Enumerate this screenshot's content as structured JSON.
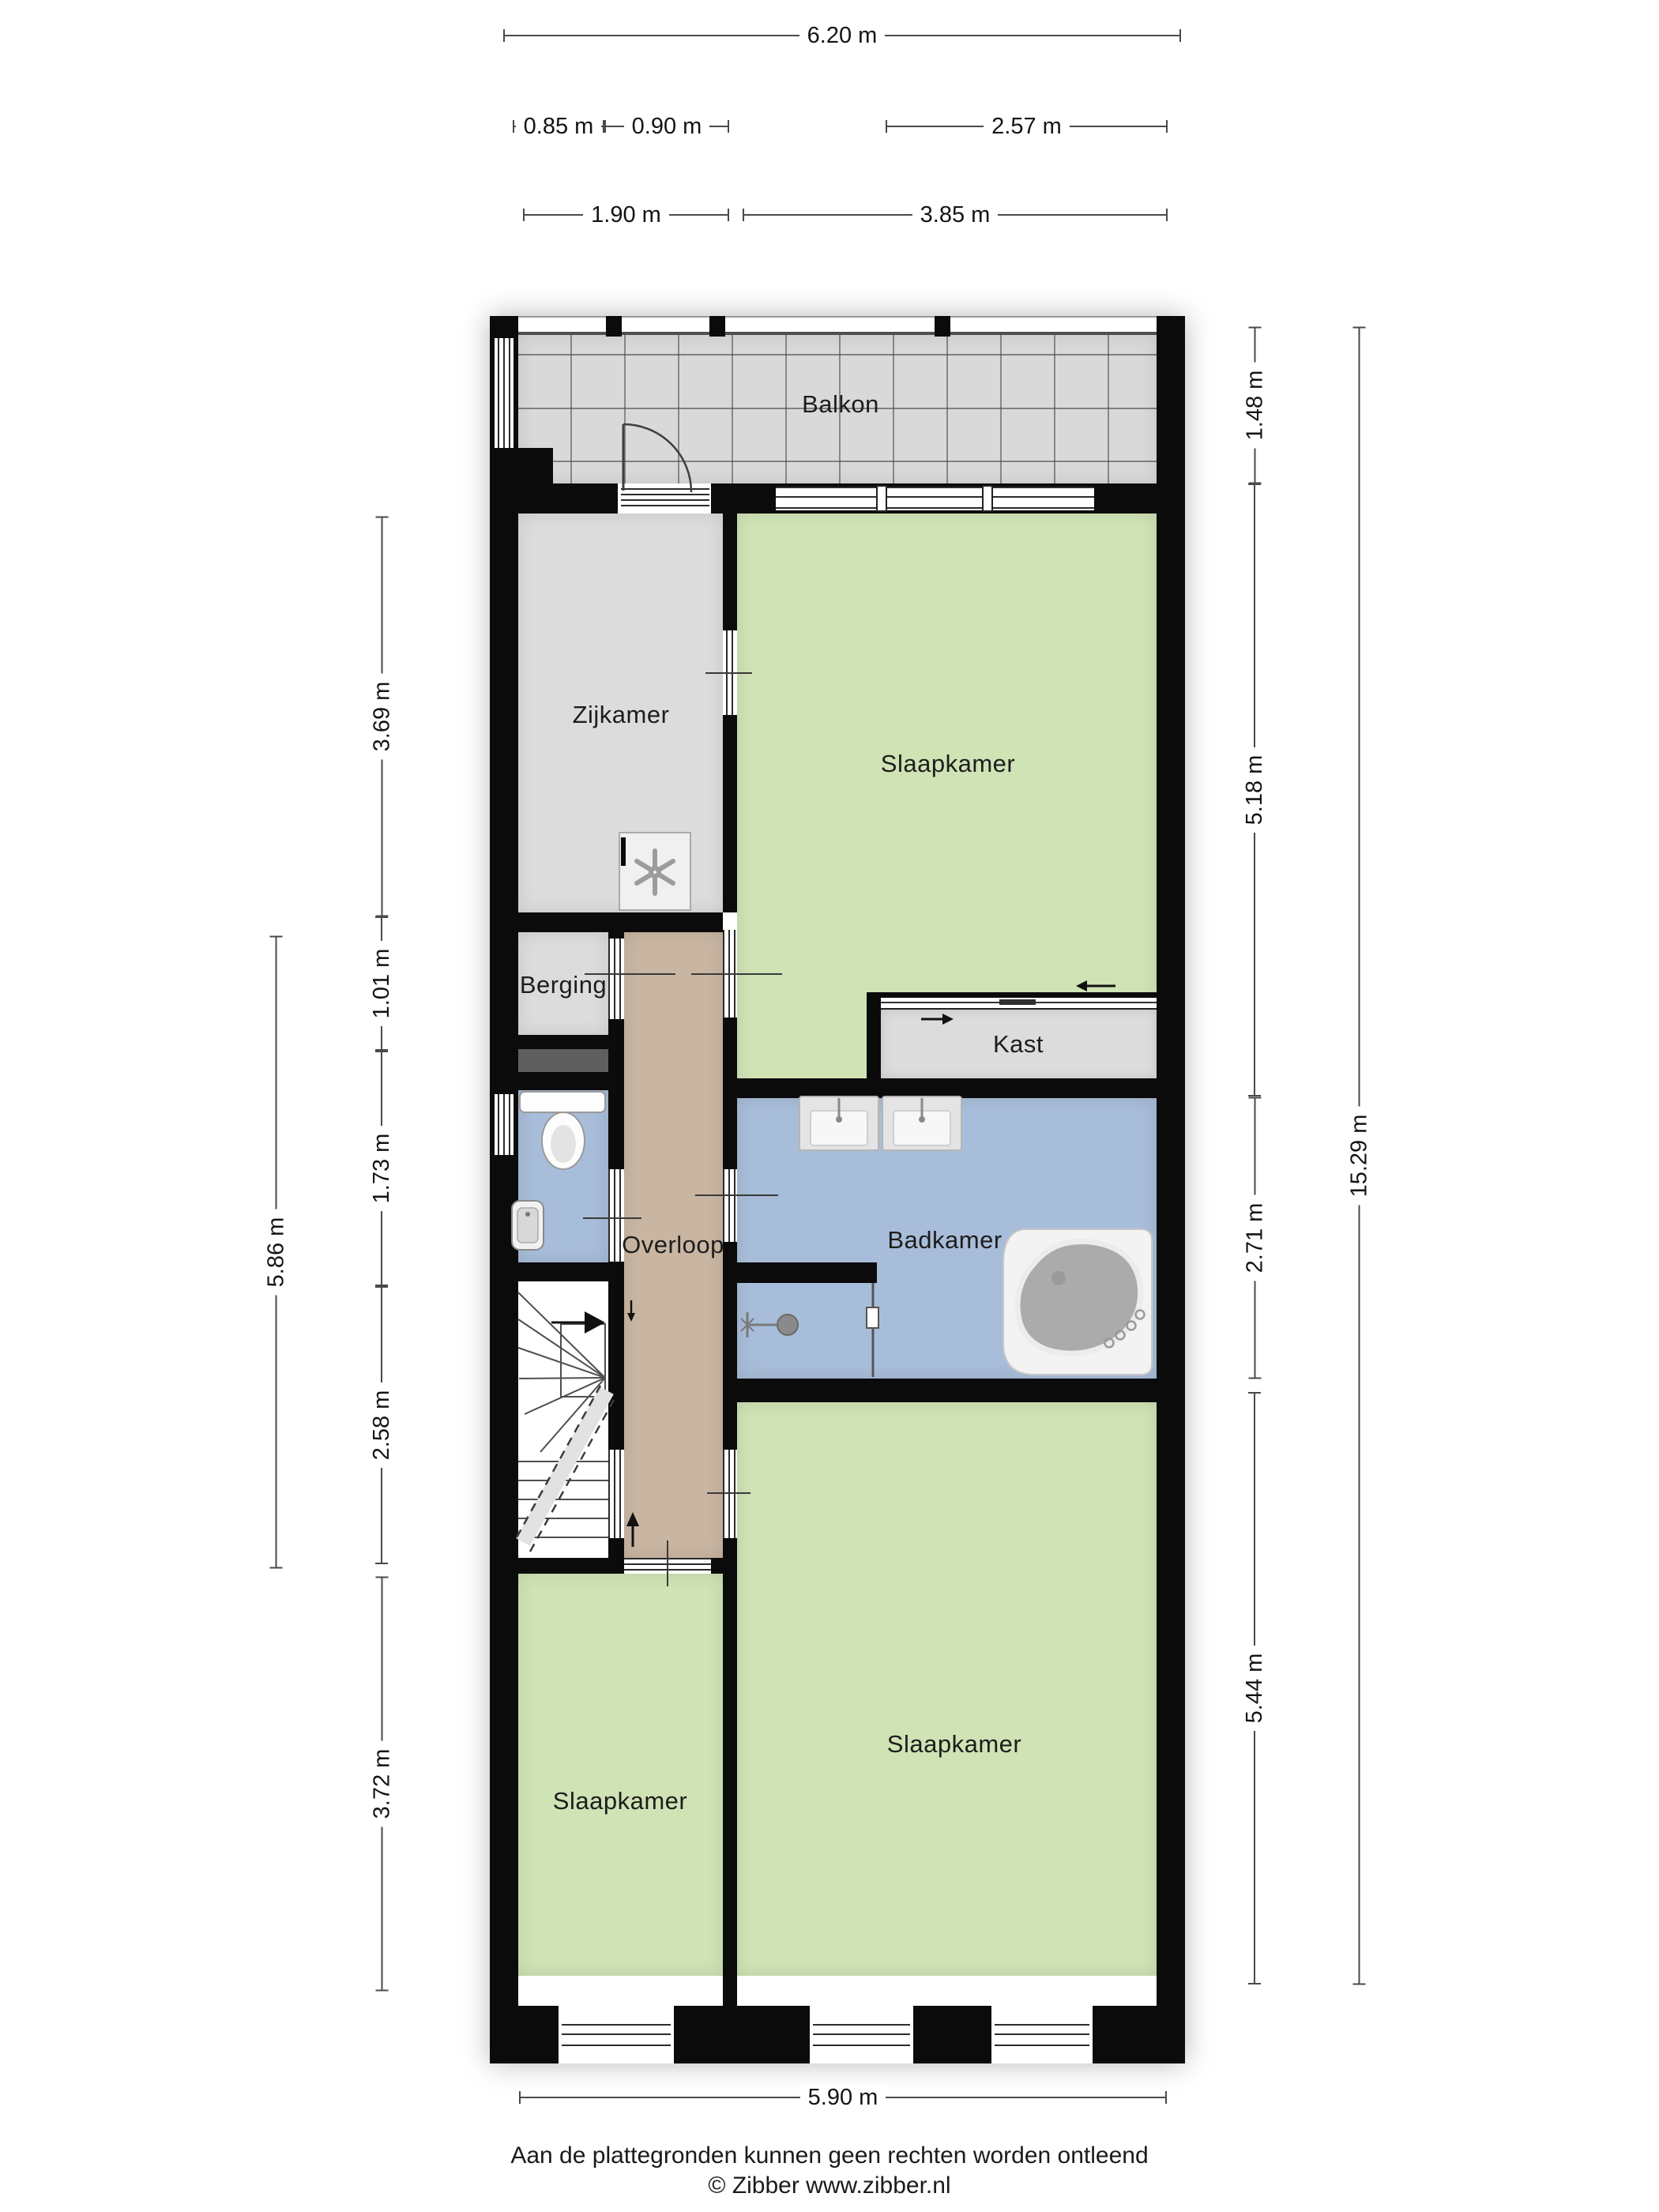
{
  "rooms": {
    "balkon": {
      "label": "Balkon"
    },
    "zijkamer": {
      "label": "Zijkamer"
    },
    "slaapkamer_top": {
      "label": "Slaapkamer"
    },
    "berging": {
      "label": "Berging"
    },
    "kast": {
      "label": "Kast"
    },
    "overloop": {
      "label": "Overloop"
    },
    "badkamer": {
      "label": "Badkamer"
    },
    "slaapkamer_left": {
      "label": "Slaapkamer"
    },
    "slaapkamer_right": {
      "label": "Slaapkamer"
    }
  },
  "dimensions": {
    "total_width": "6.20 m",
    "berging_width": "0.85 m",
    "overloop_width": "0.90 m",
    "kast_width": "2.57 m",
    "zijkamer_width": "1.90 m",
    "slaapkamer_width": "3.85 m",
    "balkon_height": "1.48 m",
    "slaapkamer_top_height": "5.18 m",
    "badkamer_height": "2.71 m",
    "slaapkamer_right_height": "5.44 m",
    "total_height": "15.29 m",
    "zijkamer_height": "3.69 m",
    "berging_height": "1.01 m",
    "toilet_height": "1.73 m",
    "trap_height": "2.58 m",
    "slaapkamer_left_height": "3.72 m",
    "left_mid_height": "5.86 m",
    "bottom_width": "5.90 m"
  },
  "footer": {
    "disclaimer": "Aan de plattegronden kunnen geen rechten worden ontleend",
    "copyright": "© Zibber www.zibber.nl"
  },
  "colors": {
    "wall": "#0b0b0b",
    "green": "#cfe3b5",
    "blue": "#a8bdd9",
    "tan": "#c9b6a2",
    "gray": "#dcdcdc",
    "balcony": "#d9d9d9",
    "niche": "#5f5f5f"
  }
}
